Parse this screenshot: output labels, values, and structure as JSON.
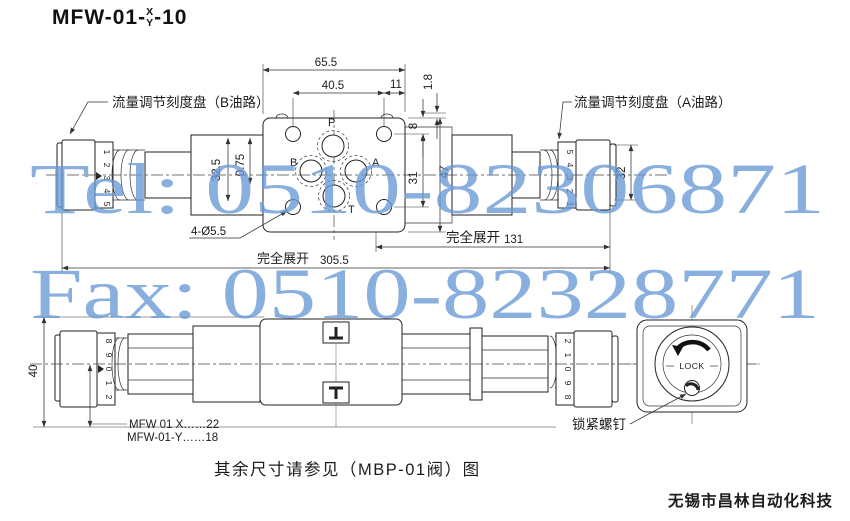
{
  "title": {
    "prefix": "MFW-01-",
    "numerator": "X",
    "denominator": "Y",
    "suffix": "-10"
  },
  "watermark": {
    "line1": "Tel: 0510-82306871",
    "line2": "Fax: 0510-82328771",
    "color": "#6898d6"
  },
  "top_view": {
    "label_b": "流量调节刻度盘（B油路）",
    "label_a": "流量调节刻度盘（A油路）",
    "ports": {
      "p": "P",
      "b": "B",
      "a": "A",
      "t": "T"
    },
    "hole_note": "4-Ø5.5",
    "extend_label": "完全展开",
    "scale_left": [
      "1",
      "2",
      "3",
      "4",
      "5"
    ],
    "scale_right": [
      "5",
      "4",
      "3",
      "2",
      "1"
    ],
    "dims": {
      "total_width": "65.5",
      "bolt_spacing": "40.5",
      "edge_offset": "11",
      "step": "1.8",
      "top_to_hole": "8",
      "hole_spacing": "31",
      "total_height": "47",
      "collar": "32.5",
      "collar_step": "0.75",
      "knob_od": "32",
      "extended_knob": "131",
      "extended_total": "305.5"
    }
  },
  "side_view": {
    "height": "40",
    "scale_left": [
      "8",
      "9",
      "0",
      "1",
      "2"
    ],
    "scale_right": [
      "2",
      "1",
      "0",
      "9",
      "8"
    ],
    "variant_x": "MFW 01 X……22",
    "variant_y": "MFW-01-Y……18",
    "lock_screw_label": "锁紧螺钉",
    "lock_text": "LOCK"
  },
  "caption": "其余尺寸请参见（MBP-01阀）图",
  "company": "无锡市昌林自动化科技"
}
